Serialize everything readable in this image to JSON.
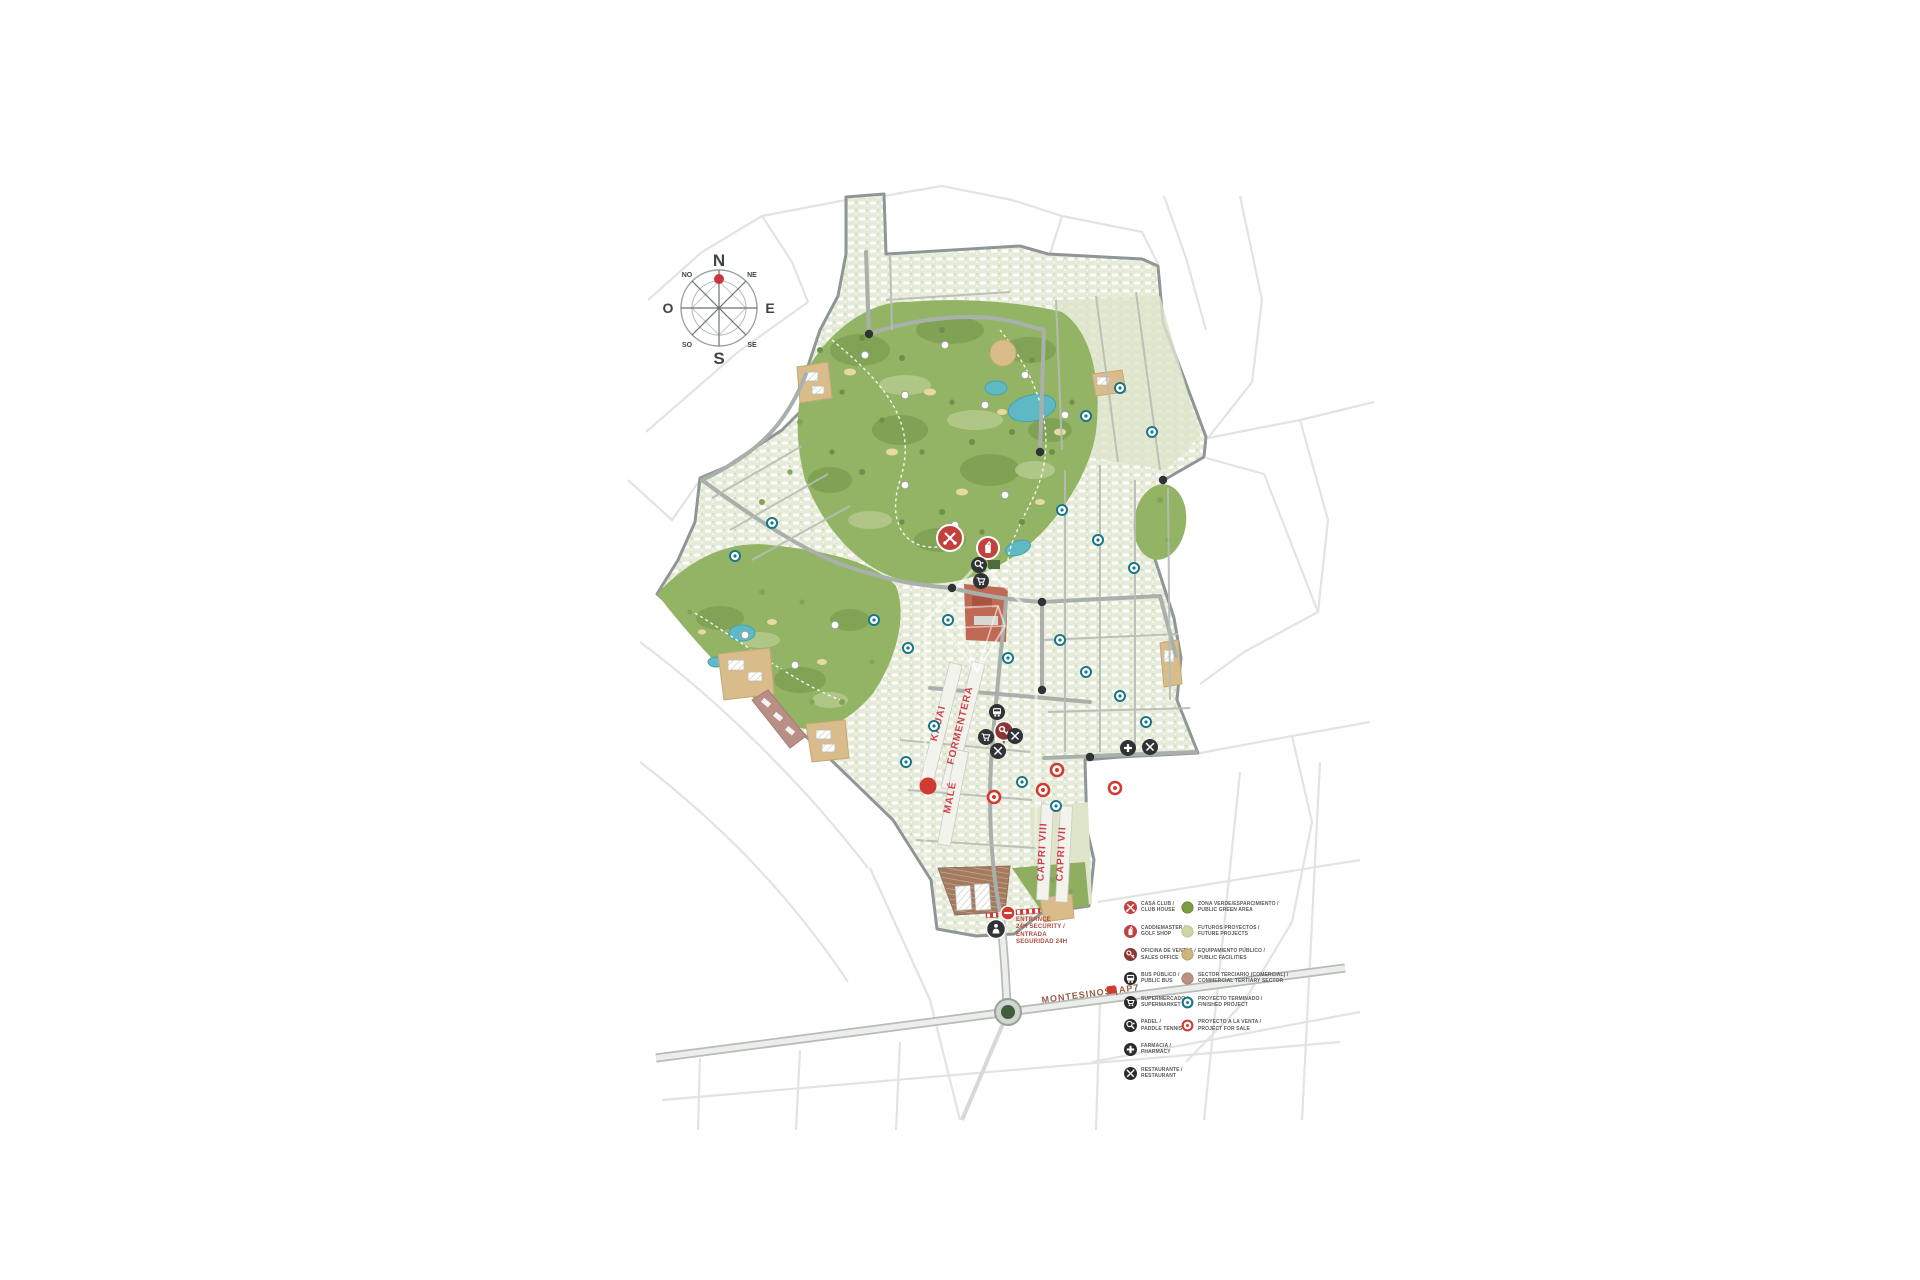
{
  "compass": {
    "north": "N",
    "south": "S",
    "east": "E",
    "west": "O",
    "northwest": "NO",
    "northeast": "NE",
    "southwest": "SO",
    "southeast": "SE"
  },
  "map": {
    "district_labels": {
      "kauai": "KAUAI",
      "formentera": "FORMENTERA",
      "male": "MALÉ",
      "capri_viii": "CAPRI VIII",
      "capri_vii": "CAPRI VII"
    },
    "entrance": {
      "line1": "ENTRANCE",
      "line2": "24h SECURITY /",
      "line3": "ENTRADA",
      "line4": "SEGURIDAD 24H"
    },
    "road": {
      "name": "MONTESINOS |",
      "highway": "AP7"
    }
  },
  "legend": {
    "services": [
      {
        "id": "club-house",
        "es": "CASA CLUB /",
        "en": "CLUB HOUSE",
        "color": "#c2403e"
      },
      {
        "id": "golf-shop",
        "es": "CADDIEMASTER /",
        "en": "GOLF SHOP",
        "color": "#c2403e"
      },
      {
        "id": "sales-office",
        "es": "OFICINA DE VENTAS /",
        "en": "SALES OFFICE",
        "color": "#8e3434"
      },
      {
        "id": "public-bus",
        "es": "BUS PÚBLICO /",
        "en": "PUBLIC BUS",
        "color": "#2b2b2b"
      },
      {
        "id": "supermarket",
        "es": "SUPERMERCADO /",
        "en": "SUPERMARKET",
        "color": "#2b2b2b"
      },
      {
        "id": "paddle-tennis",
        "es": "PADEL /",
        "en": "PADDLE TENNIS",
        "color": "#2b2b2b"
      },
      {
        "id": "pharmacy",
        "es": "FARMACIA /",
        "en": "PHARMACY",
        "color": "#2b2b2b"
      },
      {
        "id": "restaurant",
        "es": "RESTAURANTE /",
        "en": "RESTAURANT",
        "color": "#2b2b2b"
      }
    ],
    "zones": [
      {
        "id": "public-green-area",
        "es": "ZONA VERDE/ESPARCIMIENTO /",
        "en": "PUBLIC GREEN AREA",
        "color": "#7b9c3f",
        "style": "solid"
      },
      {
        "id": "future-projects",
        "es": "FUTUROS PROYECTOS /",
        "en": "FUTURE PROJECTS",
        "color": "#ccd6a3",
        "style": "solid"
      },
      {
        "id": "public-facilities",
        "es": "EQUIPAMIENTO PÚBLICO /",
        "en": "PUBLIC FACILITIES",
        "color": "#cfb47c",
        "style": "solid"
      },
      {
        "id": "commercial-tertiary-sector",
        "es": "SECTOR TERCIARIO (COMERCIAL) /",
        "en": "COMMERCIAL TERTIARY SECTOR",
        "color": "#bd8f85",
        "style": "solid"
      },
      {
        "id": "finished-project",
        "es": "PROYECTO TERMINADO /",
        "en": "FINISHED PROJECT",
        "color": "#19768a",
        "style": "ring"
      },
      {
        "id": "project-for-sale",
        "es": "PROYECTO A LA VENTA /",
        "en": "PROJECT FOR SALE",
        "color": "#d03a31",
        "style": "ring"
      }
    ]
  },
  "colors": {
    "residential_base": "#e6ead8",
    "golf_green": "#93b465",
    "fairway": "#b3c98b",
    "pond": "#5fb9c4",
    "sand": "#e8d9a4",
    "tan_parcel": "#d9bc8a",
    "terracotta": "#bf6a55",
    "mauve_commercial": "#b98e84",
    "parking_brown": "#a3795f",
    "road_gray": "#a9b0ac",
    "outside_streets": "#e3e3e3",
    "marker_black": "#2f3335",
    "brand_red": "#d03a31",
    "dark_red": "#8e3434",
    "teal": "#19768a",
    "district_label_red": "#cf3f4a",
    "entrance_text": "#b0483c",
    "road_label_brown": "#9b5b45"
  }
}
